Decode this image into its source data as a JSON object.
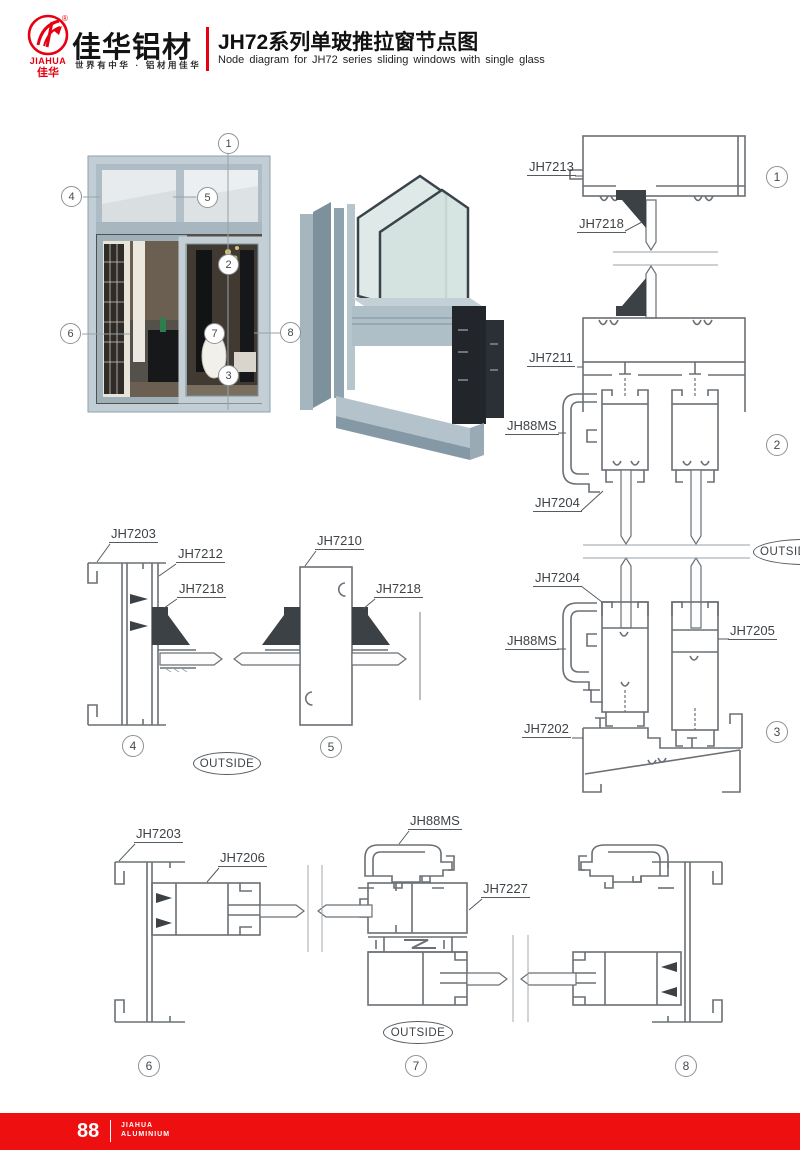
{
  "header": {
    "logo": {
      "brand_en": "JIAHUA",
      "brand_cn": "佳华",
      "reg_mark": "®"
    },
    "company_name": "佳华铝材",
    "slogan": "世界有中华 · 铝材用佳华",
    "title_cn": "JH72系列单玻推拉窗节点图",
    "title_en": "Node diagram for JH72 series sliding windows with single glass"
  },
  "callouts": [
    "1",
    "2",
    "3",
    "4",
    "5",
    "6",
    "7",
    "8"
  ],
  "parts": {
    "jh7213": "JH7213",
    "jh7218": "JH7218",
    "jh7211": "JH7211",
    "jh88ms": "JH88MS",
    "jh7204": "JH7204",
    "jh7205": "JH7205",
    "jh7202": "JH7202",
    "jh7203": "JH7203",
    "jh7212": "JH7212",
    "jh7210": "JH7210",
    "jh7206": "JH7206",
    "jh7227": "JH7227"
  },
  "outside_label": "OUTSIDE",
  "footer": {
    "page_number": "88",
    "brand_line1": "JIAHUA",
    "brand_line2": "ALUMINIUM"
  },
  "colors": {
    "brand_red": "#e60012",
    "footer_red": "#ee0f10",
    "drawing_gray": "#6a7075",
    "label_dark": "#3e4347",
    "aluminum_light": "#b9c5cd"
  }
}
